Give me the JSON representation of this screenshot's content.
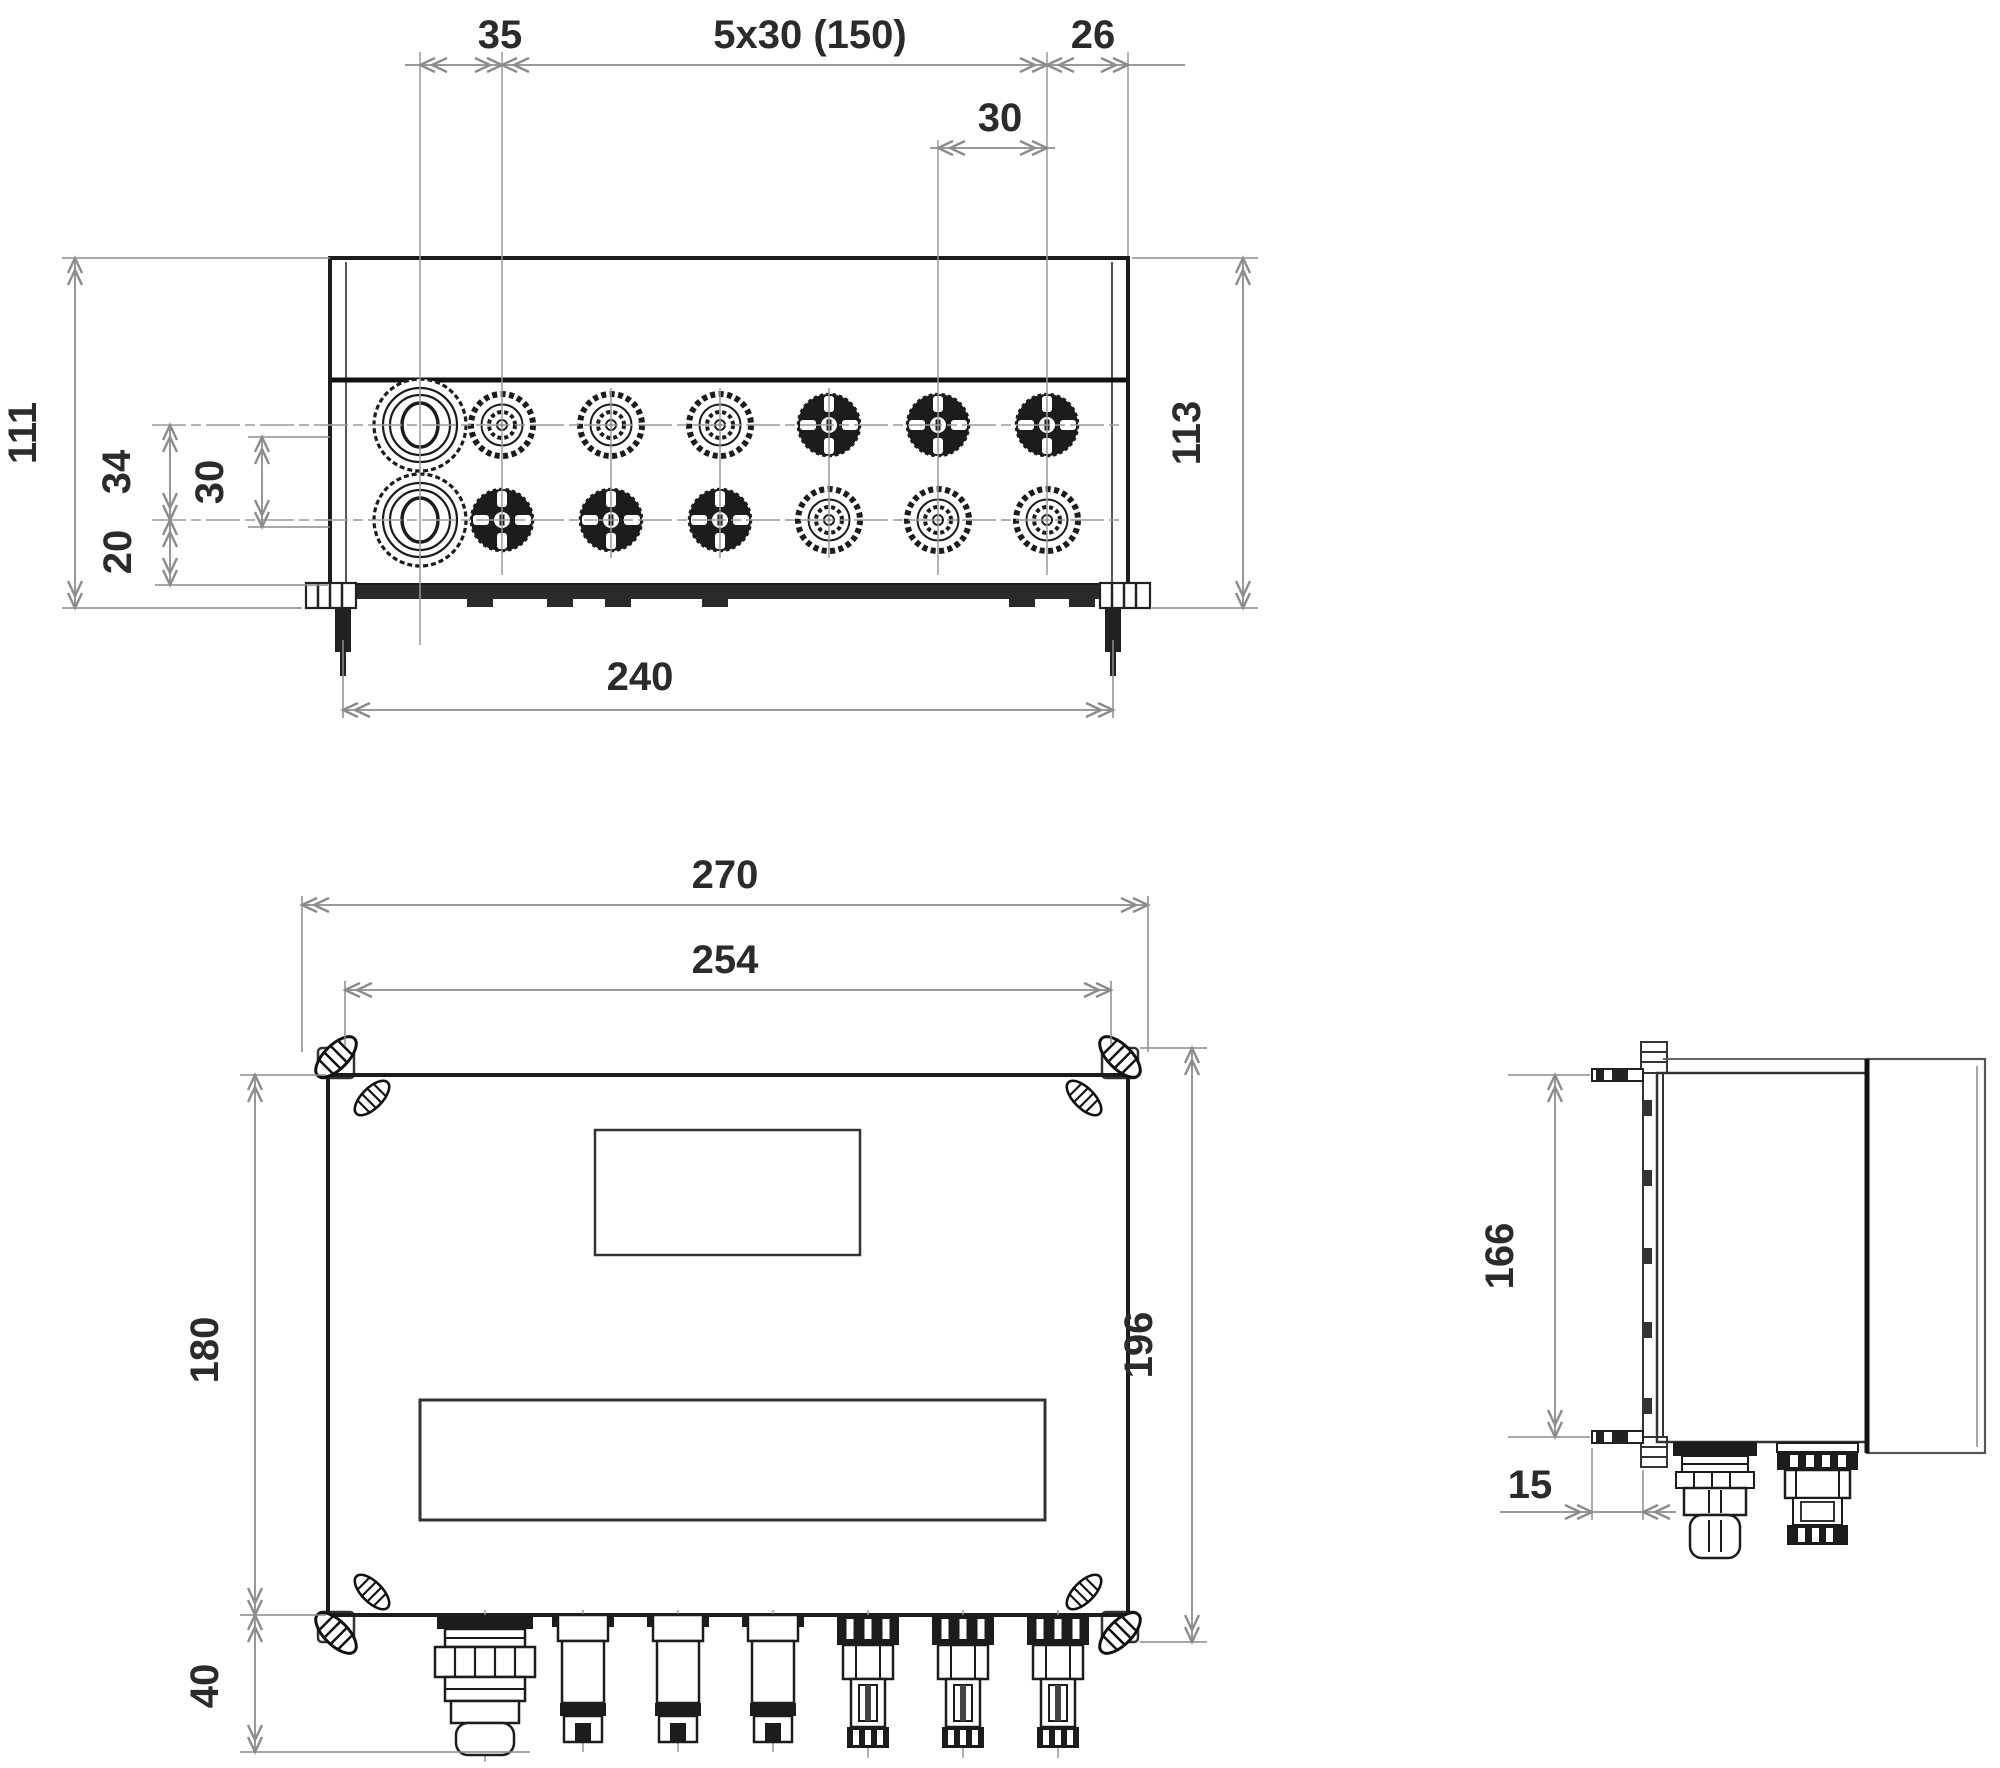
{
  "drawing": {
    "background": "#ffffff",
    "line_color": "#1c1c1c",
    "dim_color": "#8c8c8c",
    "text_color": "#2b2b2b",
    "views": {
      "top": {
        "name": "top-view",
        "dimensions": {
          "gland_offset": "35",
          "connector_pitch": "5x30 (150)",
          "edge_offset": "26",
          "pitch_single": "30",
          "height_left": "111",
          "row_offset": "34",
          "row_pitch": "30",
          "flange_offset": "20",
          "height_right": "113",
          "mounting_width": "240"
        }
      },
      "front": {
        "name": "front-view",
        "dimensions": {
          "total_width": "270",
          "mounting_pitch": "254",
          "body_height": "180",
          "gland_length": "40",
          "total_height": "196"
        }
      },
      "side": {
        "name": "side-view",
        "dimensions": {
          "mounting_height": "166",
          "flange_offset": "15"
        }
      }
    }
  }
}
